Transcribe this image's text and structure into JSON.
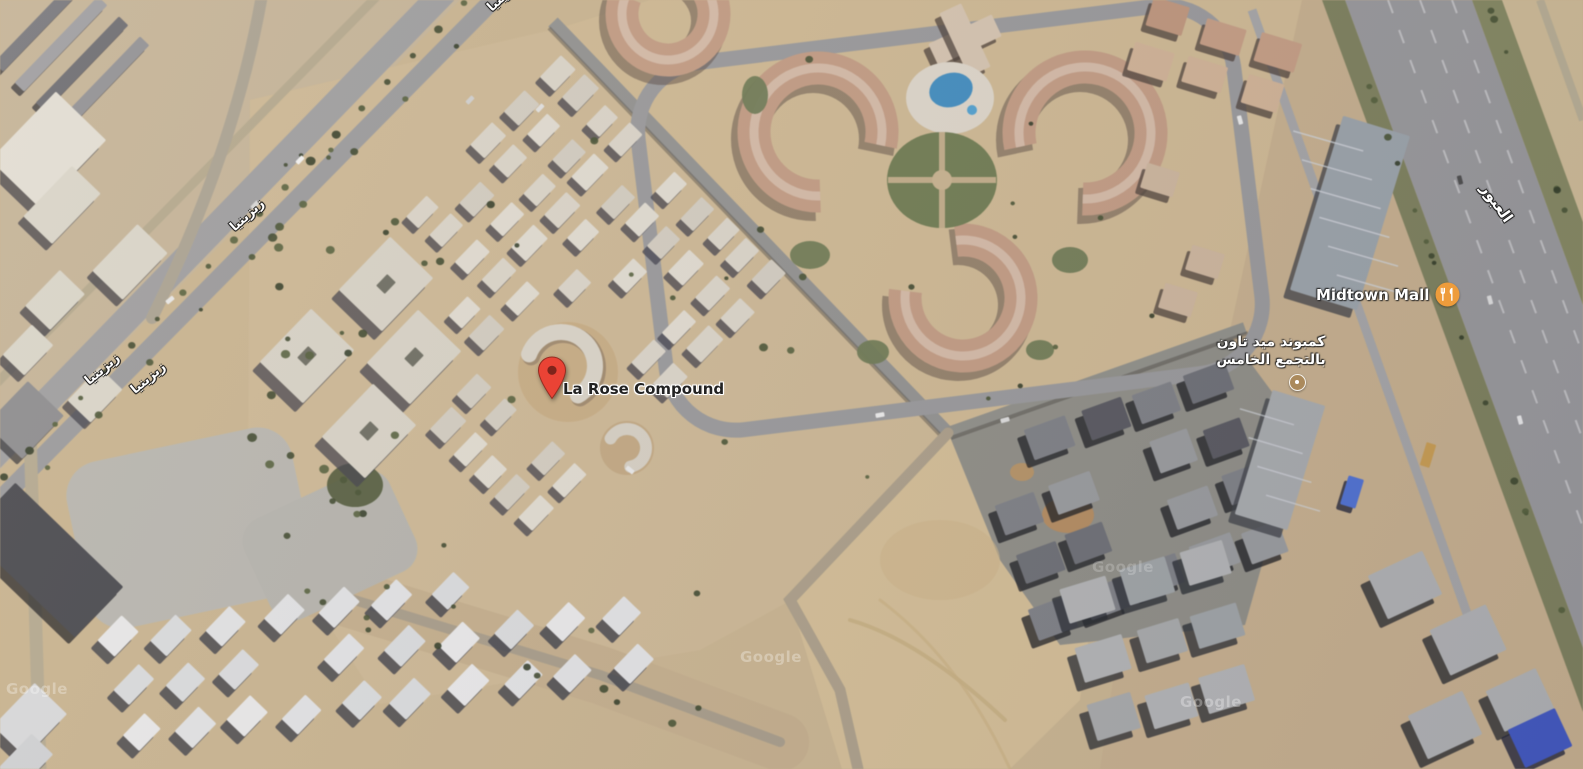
{
  "colors": {
    "pin_red": "#EA4335",
    "pin_dot": "#7E241B",
    "poi_icon_orange": "#EE9C3B",
    "poi_dot_tan": "#AB8A5C",
    "road_label_white": "#FFFFFF",
    "place_label_dark": "#222222"
  },
  "markers": {
    "la_rose": {
      "label": "La Rose Compound",
      "type": "searched-place-pin"
    },
    "midtown_mall": {
      "label": "Midtown Mall",
      "icon": "restaurant-icon"
    },
    "midtown_compound": {
      "label_line1": "كمبوند ميد تاون",
      "label_line2": "بالتجمع الخامس",
      "icon": "poi-dot-marker"
    }
  },
  "road_labels": [
    {
      "text": "زيزينيا"
    },
    {
      "text": "زيزينيا"
    },
    {
      "text": "زيزينيا"
    },
    {
      "text": "زيزينيا"
    },
    {
      "text": "العبور"
    }
  ],
  "attribution": {
    "watermark": "Google"
  }
}
